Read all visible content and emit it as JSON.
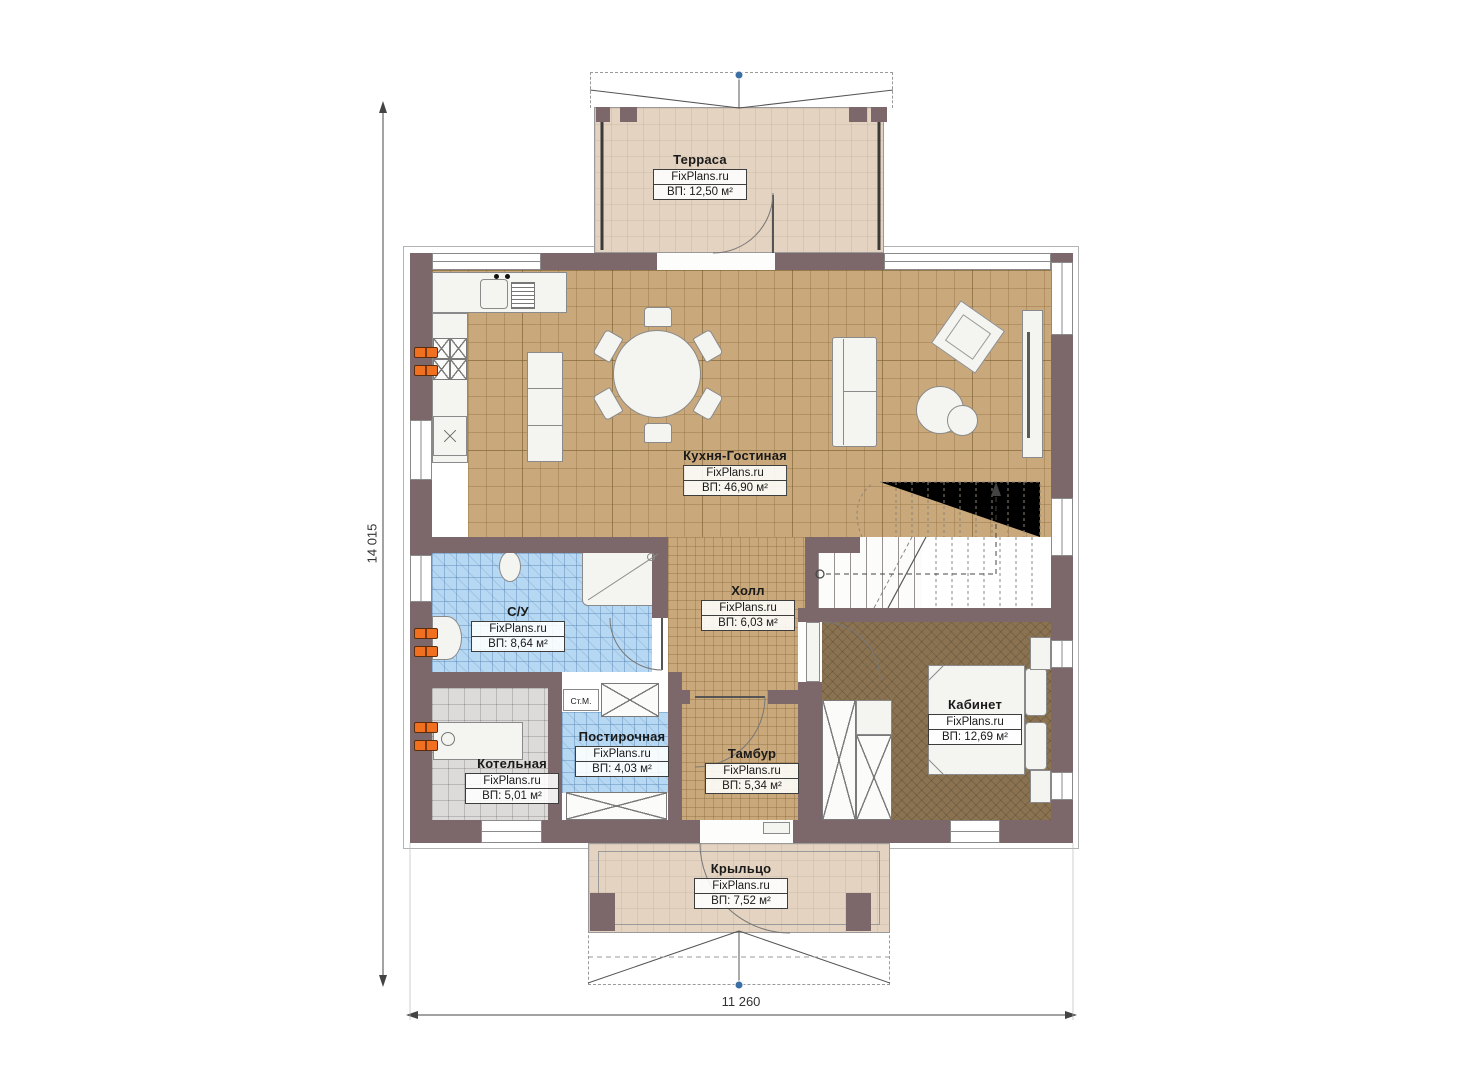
{
  "plan": {
    "brand": "FixPlans.ru",
    "dimensions": {
      "left_total": "14 015",
      "bottom_total": "11 260"
    }
  },
  "rooms": {
    "terrace": {
      "name": "Терраса",
      "brand": "FixPlans.ru",
      "area": "ВП: 12,50 м²"
    },
    "kitchen": {
      "name": "Кухня-Гостиная",
      "brand": "FixPlans.ru",
      "area": "ВП: 46,90 м²"
    },
    "hall": {
      "name": "Холл",
      "brand": "FixPlans.ru",
      "area": "ВП: 6,03 м²"
    },
    "bathroom": {
      "name": "С/У",
      "brand": "FixPlans.ru",
      "area": "ВП: 8,64 м²"
    },
    "boiler": {
      "name": "Котельная",
      "brand": "FixPlans.ru",
      "area": "ВП: 5,01 м²"
    },
    "laundry": {
      "name": "Постирочная",
      "brand": "FixPlans.ru",
      "area": "ВП: 4,03 м²"
    },
    "vestibule": {
      "name": "Тамбур",
      "brand": "FixPlans.ru",
      "area": "ВП: 5,34 м²"
    },
    "office": {
      "name": "Кабинет",
      "brand": "FixPlans.ru",
      "area": "ВП: 12,69 м²"
    },
    "porch": {
      "name": "Крыльцо",
      "brand": "FixPlans.ru",
      "area": "ВП: 7,52 м²"
    }
  },
  "labels": {
    "washing_machine": "Ст.М."
  },
  "colors": {
    "wall": "#7c686b",
    "floor_wood": "#c9a87c",
    "floor_bath": "#b7d8f3",
    "floor_boiler": "#dcdbd9",
    "floor_office": "#8b7352",
    "floor_deck": "#e3d3c0",
    "radiator": "#f07020",
    "marker_blue": "#3b6ea5"
  }
}
